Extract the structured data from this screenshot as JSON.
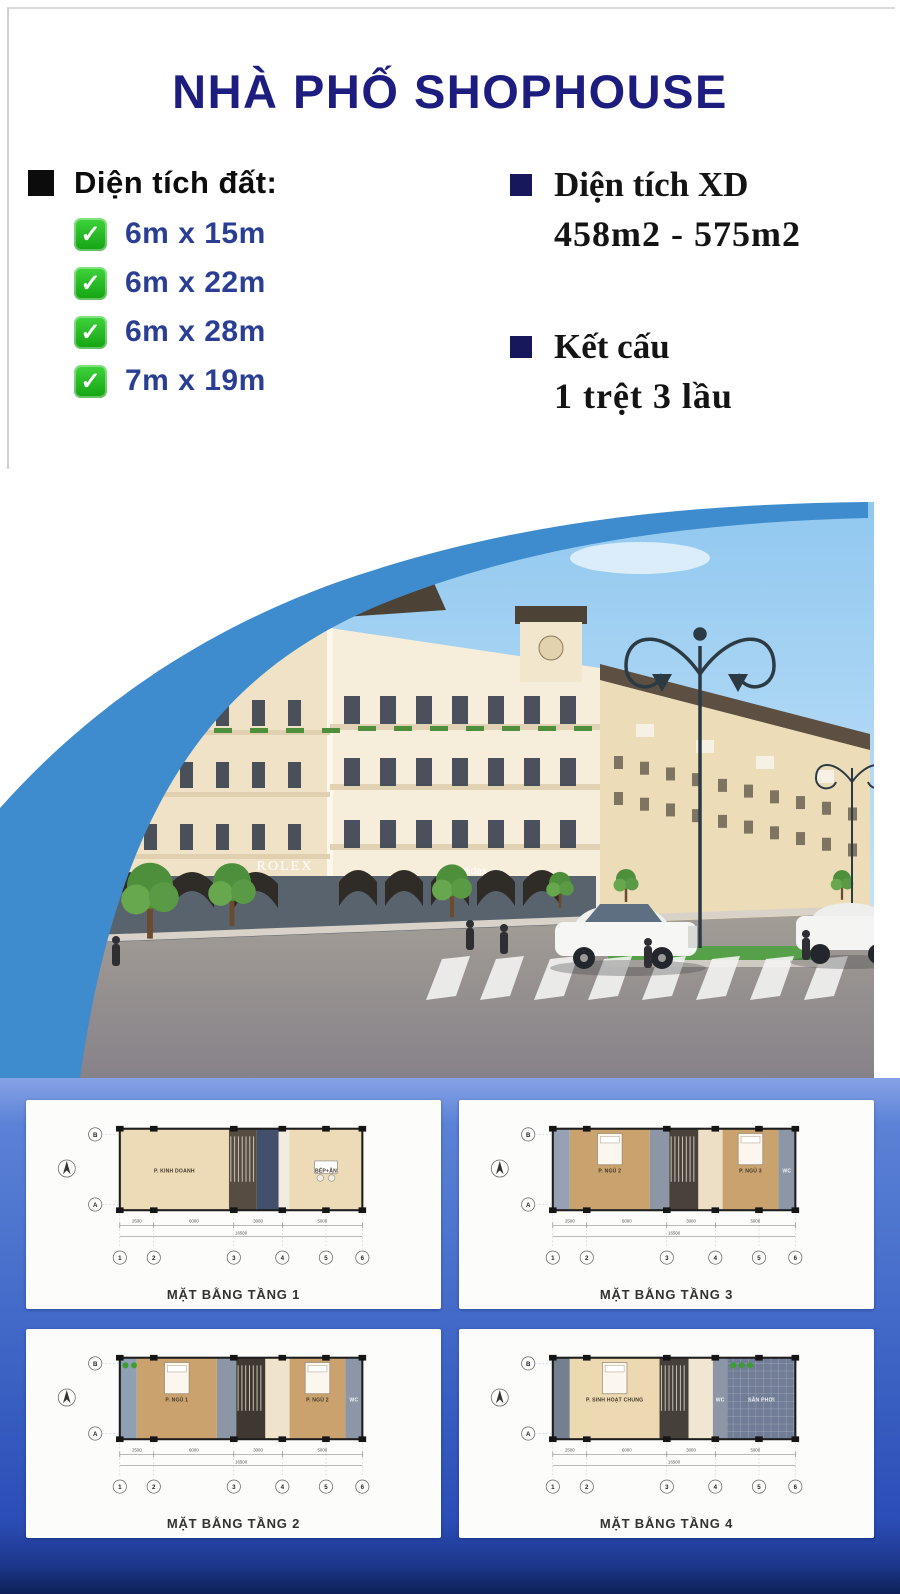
{
  "header": {
    "title": "NHÀ PHỐ SHOPHOUSE"
  },
  "specs": {
    "land": {
      "label": "Diện tích đất:",
      "items": [
        {
          "check": "✓",
          "text": "6m x 15m"
        },
        {
          "check": "✓",
          "text": "6m x 22m"
        },
        {
          "check": "✓",
          "text": "6m x 28m"
        },
        {
          "check": "✓",
          "text": "7m x 19m"
        }
      ]
    },
    "build": {
      "label": "Diện tích XD",
      "value": "458m2 - 575m2"
    },
    "structure": {
      "label": "Kết cấu",
      "value": "1 trệt 3 lầu"
    }
  },
  "photo": {
    "description": "3D rendering of classic-style shophouse street corner",
    "signs": {
      "center": "ROLEX",
      "right": "adidas"
    }
  },
  "plans": [
    {
      "caption": "MẶT BẰNG TẦNG 1",
      "grid": [
        "1",
        "2",
        "3",
        "4",
        "5",
        "6"
      ],
      "axes": [
        "B",
        "A"
      ],
      "dims": [
        "2500",
        "6000",
        "3000",
        "5000"
      ],
      "total": "16500",
      "rooms": [
        {
          "f0": 0,
          "f1": 0.45,
          "color": "#ecdbb6",
          "label": "P. KINH DOANH"
        },
        {
          "f0": 0.45,
          "f1": 0.565,
          "color": "#564c41",
          "label": "",
          "stair": true
        },
        {
          "f0": 0.565,
          "f1": 0.655,
          "color": "#42506b",
          "label": ""
        },
        {
          "f0": 0.655,
          "f1": 0.7,
          "color": "#f2ece0",
          "label": ""
        },
        {
          "f0": 0.7,
          "f1": 1,
          "color": "#ecdbb6",
          "label": "BẾP+ĂN",
          "table": true
        }
      ]
    },
    {
      "caption": "MẶT BẰNG TẦNG 3",
      "grid": [
        "1",
        "2",
        "3",
        "4",
        "5",
        "6"
      ],
      "axes": [
        "B",
        "A"
      ],
      "dims": [
        "2500",
        "6000",
        "3000",
        "5000"
      ],
      "total": "16500",
      "rooms": [
        {
          "f0": 0,
          "f1": 0.07,
          "color": "#97a1b3",
          "label": ""
        },
        {
          "f0": 0.07,
          "f1": 0.4,
          "color": "#c9a26d",
          "label": "P. NGỦ 2",
          "bed": true
        },
        {
          "f0": 0.4,
          "f1": 0.48,
          "color": "#8d96a7",
          "label": ""
        },
        {
          "f0": 0.48,
          "f1": 0.6,
          "color": "#4a423a",
          "label": "",
          "stair": true
        },
        {
          "f0": 0.6,
          "f1": 0.7,
          "color": "#ecdfc6",
          "label": ""
        },
        {
          "f0": 0.7,
          "f1": 0.93,
          "color": "#c9a26d",
          "label": "P. NGỦ 3",
          "bed": true
        },
        {
          "f0": 0.93,
          "f1": 1,
          "color": "#8d96a7",
          "label": "WC",
          "light": true
        }
      ]
    },
    {
      "caption": "MẶT BẰNG TẦNG 2",
      "grid": [
        "1",
        "2",
        "3",
        "4",
        "5",
        "6"
      ],
      "axes": [
        "B",
        "A"
      ],
      "dims": [
        "2500",
        "6000",
        "3000",
        "5000"
      ],
      "total": "16500",
      "rooms": [
        {
          "f0": 0,
          "f1": 0.07,
          "color": "#8fa0b5",
          "label": "",
          "plants": true
        },
        {
          "f0": 0.07,
          "f1": 0.4,
          "color": "#c9a26d",
          "label": "P. NGỦ 1",
          "bed": true
        },
        {
          "f0": 0.4,
          "f1": 0.48,
          "color": "#8d96a7",
          "label": ""
        },
        {
          "f0": 0.48,
          "f1": 0.6,
          "color": "#3f3831",
          "label": "",
          "stair": true
        },
        {
          "f0": 0.6,
          "f1": 0.7,
          "color": "#f0e3cb",
          "label": ""
        },
        {
          "f0": 0.7,
          "f1": 0.93,
          "color": "#c9a26d",
          "label": "P. NGỦ 2",
          "bed": true
        },
        {
          "f0": 0.93,
          "f1": 1,
          "color": "#8d96a7",
          "label": "WC",
          "light": true
        }
      ]
    },
    {
      "caption": "MẶT BẰNG TẦNG 4",
      "grid": [
        "1",
        "2",
        "3",
        "4",
        "5",
        "6"
      ],
      "axes": [
        "B",
        "A"
      ],
      "dims": [
        "2500",
        "6000",
        "3000",
        "5000"
      ],
      "total": "16500",
      "rooms": [
        {
          "f0": 0,
          "f1": 0.07,
          "color": "#75808f",
          "label": ""
        },
        {
          "f0": 0.07,
          "f1": 0.44,
          "color": "#ecd9b2",
          "label": "P. SINH HOẠT CHUNG",
          "bed": true
        },
        {
          "f0": 0.44,
          "f1": 0.56,
          "color": "#45403a",
          "label": "",
          "stair": true
        },
        {
          "f0": 0.56,
          "f1": 0.66,
          "color": "#f0e6d2",
          "label": ""
        },
        {
          "f0": 0.66,
          "f1": 0.72,
          "color": "#8d96a7",
          "label": "WC",
          "light": true
        },
        {
          "f0": 0.72,
          "f1": 1,
          "color": "#717d96",
          "label": "SÂN PHƠI",
          "light": true,
          "tile": true,
          "plants": true
        }
      ]
    }
  ],
  "colors": {
    "title_navy": "#1d1d80",
    "list_navy": "#2a3e93",
    "check_green": "#24c32b",
    "swoosh_blue": "#3e8ccd",
    "panel_blue_top": "#5b82d6",
    "panel_blue_bottom": "#0d2056"
  }
}
